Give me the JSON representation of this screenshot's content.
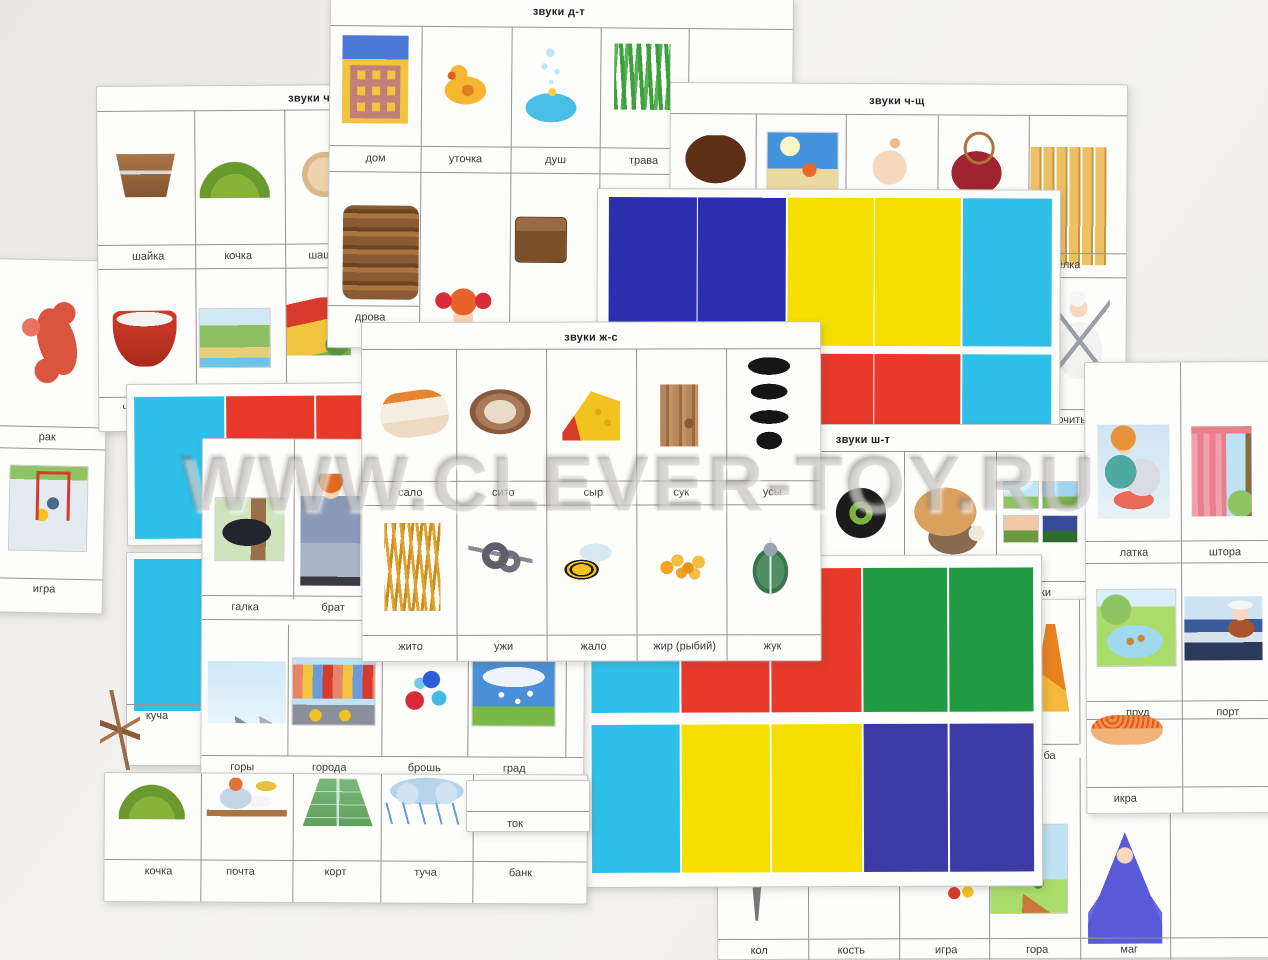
{
  "watermark": "WWW.CLEVER-TOY.RU",
  "block_colors": {
    "blue": "#2a2fae",
    "yellow": "#f6df00",
    "cyan": "#2fc0ea",
    "red": "#e8392b",
    "green": "#219a44",
    "navy": "#3c3ba6"
  },
  "cards": {
    "dt": {
      "title": "звуки д-т",
      "row1_labels": [
        "дом",
        "уточка",
        "душ",
        "трава"
      ],
      "row2_labels": [
        "дрова"
      ],
      "pictures": [
        "house",
        "duckling",
        "shower-bath",
        "grass",
        "firewood",
        "girl",
        "chest"
      ]
    },
    "ch": {
      "title": "звуки ч",
      "row1_labels": [
        "шайка",
        "кочка",
        "шаш"
      ],
      "row2_labels": [
        "ч"
      ],
      "pictures": [
        "wooden-tub",
        "hillock",
        "checker-piece",
        "red-cup",
        "riverbank",
        "cottage"
      ]
    },
    "chsch": {
      "title": "звуки ч-щ",
      "row1_labels": [
        "щёлка"
      ],
      "row2_labels": [
        "точить"
      ],
      "pictures": [
        "hair-fringe",
        "beach",
        "crying-baby",
        "wax-seal",
        "fence-gap",
        "cook-sharpening-knife"
      ]
    },
    "zhs": {
      "title": "звуки ж-с",
      "row1_labels": [
        "сало",
        "сито",
        "сыр",
        "сук",
        "усы"
      ],
      "row2_labels": [
        "жито",
        "ужи",
        "жало",
        "жир (рыбий)",
        "жук"
      ],
      "pictures": [
        "lard",
        "sieve",
        "cheese",
        "tree-knot",
        "moustaches",
        "wheat",
        "snakes",
        "bee",
        "fish-oil-capsules",
        "beetle"
      ]
    },
    "sht": {
      "title": "звуки ш-т",
      "row1_labels": [
        "тки"
      ],
      "pictures": [
        "tyre",
        "ox-with-sack",
        "day-night-stamps"
      ]
    },
    "rak": {
      "labels": [
        "рак",
        "игра"
      ],
      "pictures": [
        "crayfish",
        "hockey-game"
      ]
    },
    "galka": {
      "row1_labels": [
        "галка",
        "брат"
      ],
      "row2_labels": [
        "горы",
        "города",
        "брошь",
        "град"
      ],
      "pictures": [
        "jackdaw",
        "boy-with-bag",
        "mountains",
        "city-traffic",
        "brooch",
        "hail"
      ]
    },
    "strips": {
      "label": "куча"
    },
    "tok": {
      "label": "ток"
    },
    "bottom_left": {
      "labels": [
        "кочка",
        "почта",
        "корт",
        "туча",
        "банк"
      ],
      "pictures": [
        "hillock",
        "post-office",
        "tennis-court",
        "rain-cloud"
      ]
    },
    "right_card": {
      "row1_labels": [
        "латка",
        "штора"
      ],
      "row2_labels": [
        "пруд",
        "порт"
      ],
      "row3_labels": [
        "икра"
      ],
      "pictures": [
        "sewing-patch",
        "curtain",
        "pond-with-ducks",
        "captain-port",
        "caviar"
      ]
    },
    "bottom_right": {
      "row1_labels": [
        "ба"
      ],
      "row2_labels": [
        "кол",
        "кость",
        "игра",
        "гора",
        "маг"
      ],
      "pictures": [
        "trumpet",
        "stake",
        "toys",
        "mountain-landscape",
        "wizard"
      ]
    }
  }
}
